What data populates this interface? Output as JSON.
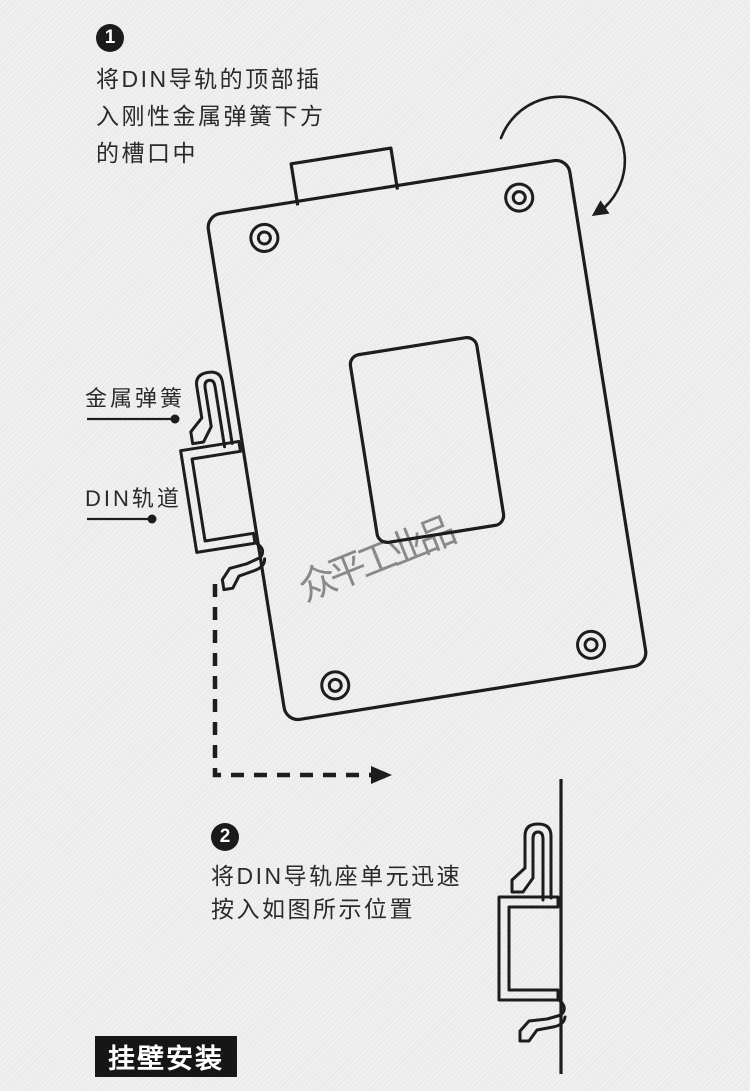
{
  "page": {
    "background_color": "#ededed",
    "ink_color": "#1d1d1d",
    "watermark_color": "#7f7f7f",
    "badge_bg": "#1b1b1b",
    "badge_fg": "#ffffff"
  },
  "steps": [
    {
      "number": "1",
      "lines": [
        "将DIN导轨的顶部插",
        "入刚性金属弹簧下方",
        "的槽口中"
      ]
    },
    {
      "number": "2",
      "lines": [
        "将DIN导轨座单元迅速",
        "按入如图所示位置"
      ]
    }
  ],
  "callouts": [
    {
      "label": "金属弹簧"
    },
    {
      "label": "DIN轨道"
    }
  ],
  "watermark": "众平工业品",
  "footer_tag": "挂壁安装",
  "icons": {
    "rotation_arrow": "clockwise-arc-arrow",
    "motion_arrow": "dashed-elbow-arrow",
    "screw_hole": "double-circle",
    "rail_bracket": "din-rail-clip-profile",
    "wall": "vertical-wall-line",
    "device": "rear-panel-outline"
  }
}
